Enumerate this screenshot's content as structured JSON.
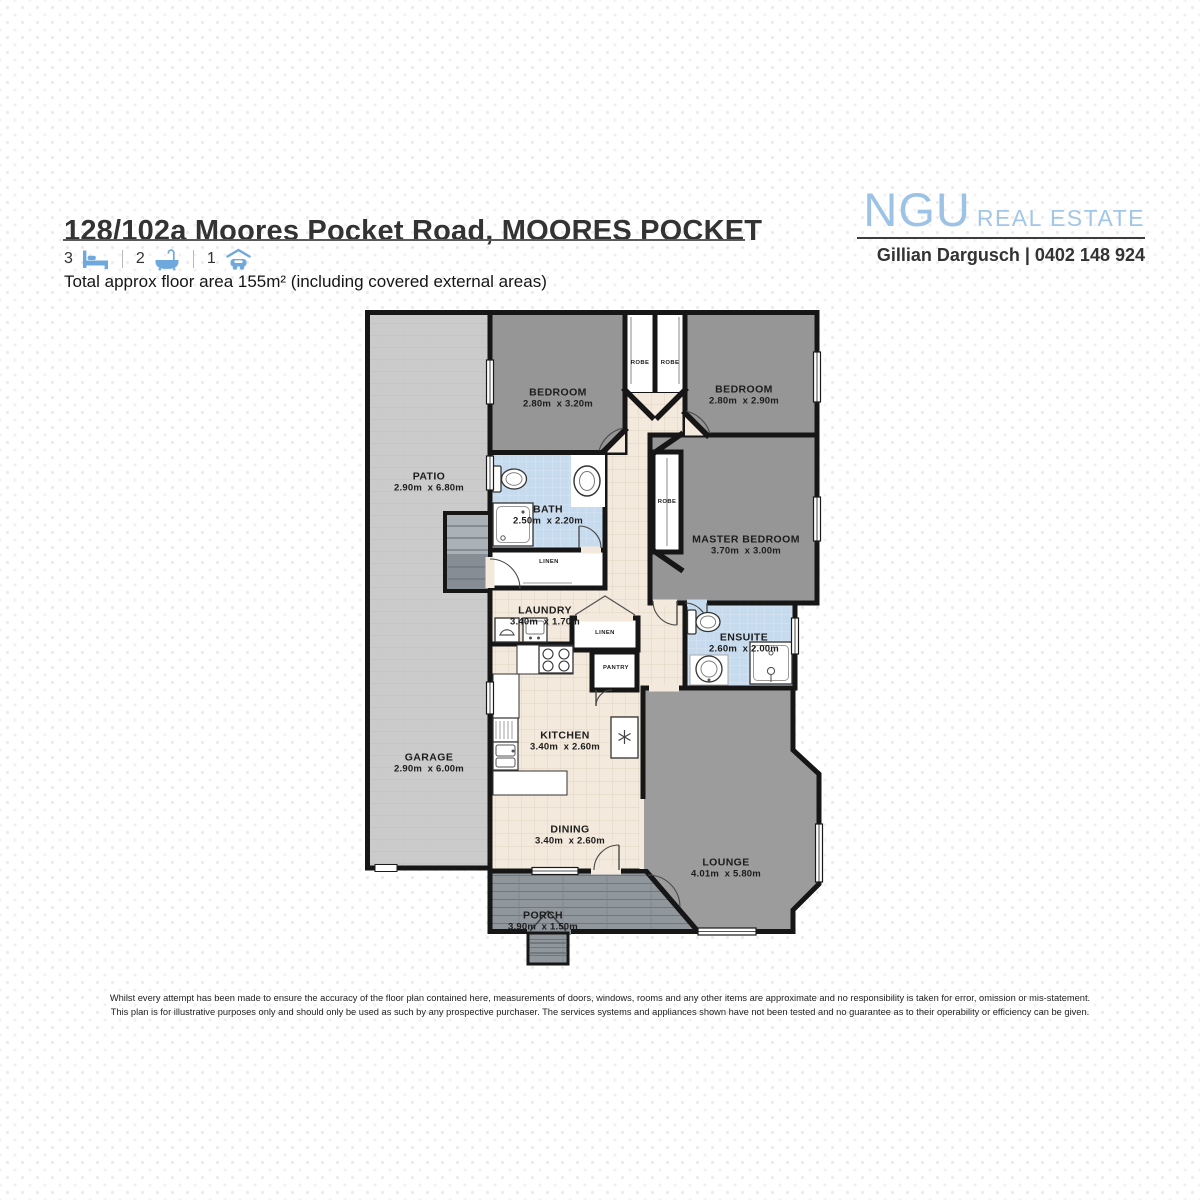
{
  "header": {
    "title": "128/102a Moores Pocket Road, MOORES POCKET",
    "area_note": "Total approx floor area 155m² (including covered external areas)",
    "features": [
      {
        "count": "3",
        "icon": "bed-icon"
      },
      {
        "count": "2",
        "icon": "bath-icon"
      },
      {
        "count": "1",
        "icon": "car-icon"
      }
    ]
  },
  "brand": {
    "logo_primary": "NGU",
    "logo_secondary": "REAL ESTATE",
    "agent_line": "Gillian Dargusch | 0402 148 924"
  },
  "floorplan": {
    "rooms": {
      "patio": {
        "name": "PATIO",
        "dims": "2.90m  x 6.80m"
      },
      "garage": {
        "name": "GARAGE",
        "dims": "2.90m  x 6.00m"
      },
      "bedroom1": {
        "name": "BEDROOM",
        "dims": "2.80m  x 3.20m"
      },
      "bedroom2": {
        "name": "BEDROOM",
        "dims": "2.80m  x 2.90m"
      },
      "master": {
        "name": "MASTER BEDROOM",
        "dims": "3.70m  x 3.00m"
      },
      "bath": {
        "name": "BATH",
        "dims": "2.50m  x 2.20m"
      },
      "laundry": {
        "name": "LAUNDRY",
        "dims": "3.40m  x 1.70m"
      },
      "ensuite": {
        "name": "ENSUITE",
        "dims": "2.60m  x 2.00m"
      },
      "kitchen": {
        "name": "KITCHEN",
        "dims": "3.40m  x 2.60m"
      },
      "dining": {
        "name": "DINING",
        "dims": "3.40m  x 2.60m"
      },
      "lounge": {
        "name": "LOUNGE",
        "dims": "4.01m  x 5.80m"
      },
      "porch": {
        "name": "PORCH",
        "dims": "3.90m  x 1.50m"
      }
    },
    "closets": {
      "robe_left": "ROBE",
      "robe_right": "ROBE",
      "robe_master": "ROBE",
      "linen_hall": "LINEN",
      "linen_laundry": "LINEN",
      "pantry": "PANTRY"
    }
  },
  "disclaimer": {
    "line1": "Whilst every attempt has been made to ensure the accuracy of the floor plan contained here, measurements of doors, windows, rooms and any other items are approximate and no responsibility is taken for error, omission or mis-statement.",
    "line2": "This plan is for illustrative purposes only and should only be used as such by any prospective purchaser. The services systems and appliances shown have not been tested and no guarantee as to their operability or efficiency can be given."
  },
  "colors": {
    "brand_blue": "#9cc2e5",
    "feature_icon_blue": "#6fa8dc",
    "wall": "#161616",
    "bedroom_fill": "#969696",
    "lounge_fill": "#9c9c9c",
    "wet_area_fill": "#c7dbee",
    "living_floor": "#f3e9dc",
    "patio_fill": "#cbcbcb",
    "porch_fill": "#8d949b"
  }
}
